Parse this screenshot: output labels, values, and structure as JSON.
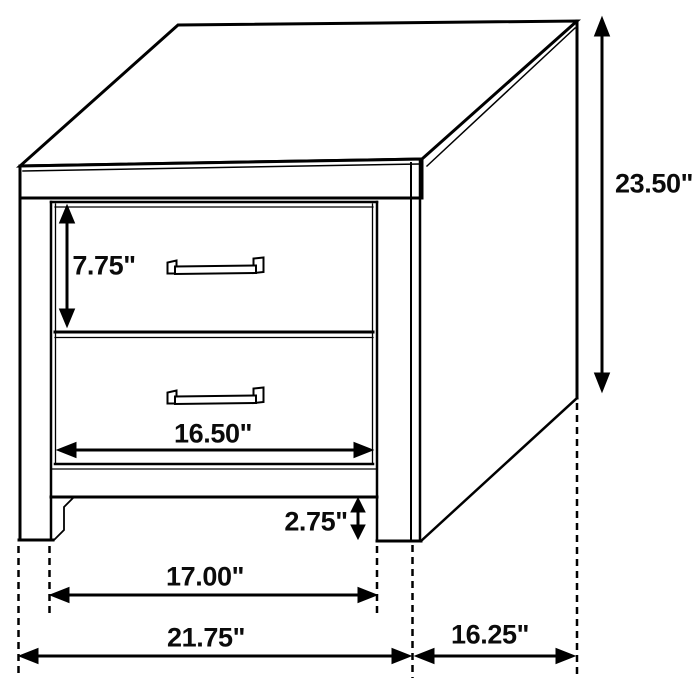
{
  "page": {
    "background": "#ffffff"
  },
  "drawing": {
    "description": "Isometric line drawing of a two-drawer nightstand with dimension annotations",
    "line_color": "#000000",
    "text_color": "#0b0b0b",
    "unit": "inches",
    "labels": {
      "height": "23.50\"",
      "top_drawer_height": "7.75\"",
      "drawer_width": "16.50\"",
      "base_clearance": "2.75\"",
      "inner_leg_width": "17.00\"",
      "overall_width": "21.75\"",
      "overall_depth": "16.25\""
    }
  }
}
